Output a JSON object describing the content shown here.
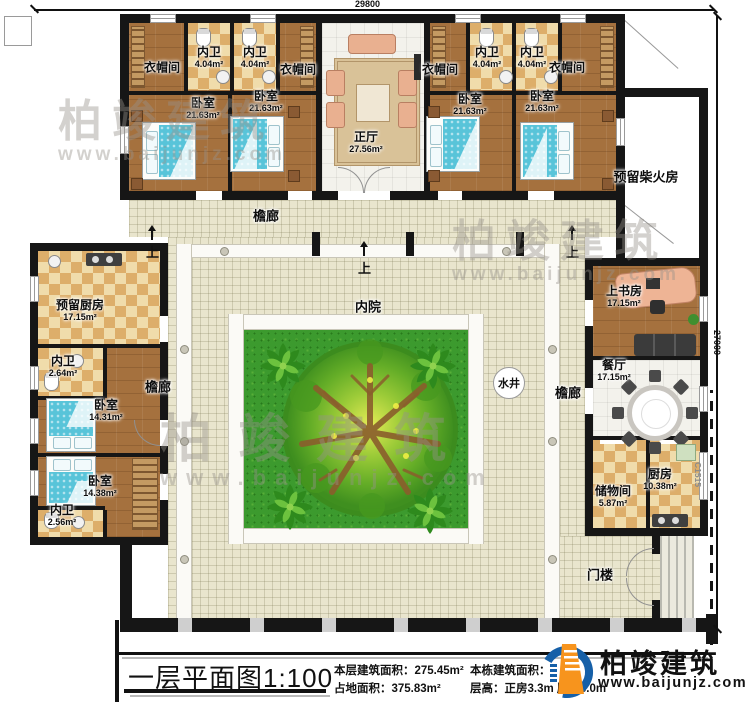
{
  "dims": {
    "top": "29800",
    "right": "27000",
    "window_tag": "C1515"
  },
  "corridor": "檐廊",
  "courtyard": {
    "label": "内院",
    "well": "水井",
    "step": "上"
  },
  "rooms": [
    {
      "label": "衣帽间",
      "area": ""
    },
    {
      "label": "内卫",
      "area": "4.04m²"
    },
    {
      "label": "内卫",
      "area": "4.04m²"
    },
    {
      "label": "衣帽间",
      "area": ""
    },
    {
      "label": "卧室",
      "area": "21.63m²"
    },
    {
      "label": "卧室",
      "area": "21.63m²"
    },
    {
      "label": "正厅",
      "area": "27.56m²"
    },
    {
      "label": "衣帽间",
      "area": ""
    },
    {
      "label": "内卫",
      "area": "4.04m²"
    },
    {
      "label": "内卫",
      "area": "4.04m²"
    },
    {
      "label": "衣帽间",
      "area": ""
    },
    {
      "label": "卧室",
      "area": "21.63m²"
    },
    {
      "label": "卧室",
      "area": "21.63m²"
    },
    {
      "label": "预留柴火房",
      "area": ""
    },
    {
      "label": "预留厨房",
      "area": "17.15m²"
    },
    {
      "label": "内卫",
      "area": "2.64m²"
    },
    {
      "label": "卧室",
      "area": "14.31m²"
    },
    {
      "label": "卧室",
      "area": "14.38m²"
    },
    {
      "label": "内卫",
      "area": "2.56m²"
    },
    {
      "label": "上书房",
      "area": "17.15m²"
    },
    {
      "label": "餐厅",
      "area": "17.15m²"
    },
    {
      "label": "储物间",
      "area": "5.87m²"
    },
    {
      "label": "厨房",
      "area": "10.38m²"
    },
    {
      "label": "门楼",
      "area": ""
    }
  ],
  "footer": {
    "title": "一层平面图1:100",
    "stats": [
      {
        "k": "本层建筑面积：",
        "v": "275.45m²"
      },
      {
        "k": "占地面积：",
        "v": "375.83m²"
      },
      {
        "k": "本栋建筑面积：",
        "v": ""
      },
      {
        "k": "层高：",
        "v": "正房3.3m 厢房3.0m"
      }
    ],
    "brand": {
      "name": "柏竣建筑",
      "site": "www.baijunjz.com"
    }
  },
  "watermark": {
    "name": "柏竣建筑",
    "site": "www.baijunjz.com"
  }
}
